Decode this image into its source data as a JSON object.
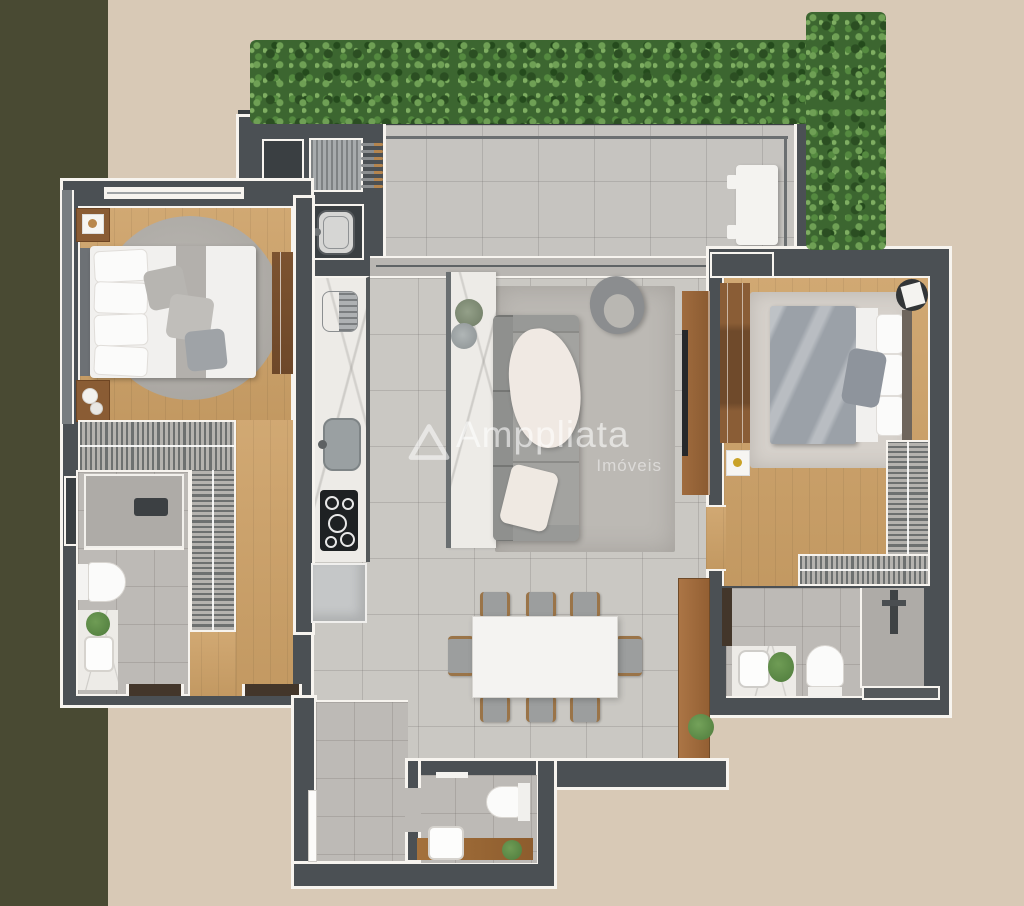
{
  "scene": "apartment-floor-plan-3d-render",
  "watermark": {
    "brand": "Amppliata",
    "subtitle": "Imóveis",
    "logo": "triangle-outline-icon"
  },
  "palette": {
    "background_beige": "#d8c9b6",
    "olive_band": "#494a33",
    "wall": "#4b5054",
    "wall_dark": "#3a3f42",
    "outline_white": "#f7f4ef",
    "tile_light": "#cac8c3",
    "tile_terrace": "#c6c4c0",
    "tile_bath": "#bdbab6",
    "shower_tile": "#aeaba7",
    "wood_floor": "#cda167",
    "wood_furniture": "#8a5c34",
    "marble": "#edebe7",
    "rug_living": "#bcb9b4",
    "rug_suite": "#d6d1cb",
    "sofa_gray": "#a3a3a0",
    "duvet_gray": "#9ba1a8",
    "hedge_green": "#3c6630",
    "hedge_light": "#6fa055",
    "hedge_dark": "#2b4e22",
    "plant_green": "#4e7b3c",
    "appliance_black": "#1e2123",
    "fridge_gray": "#c5c7c8",
    "door_wood": "#43362a",
    "white_furniture": "#f4f3f0"
  }
}
